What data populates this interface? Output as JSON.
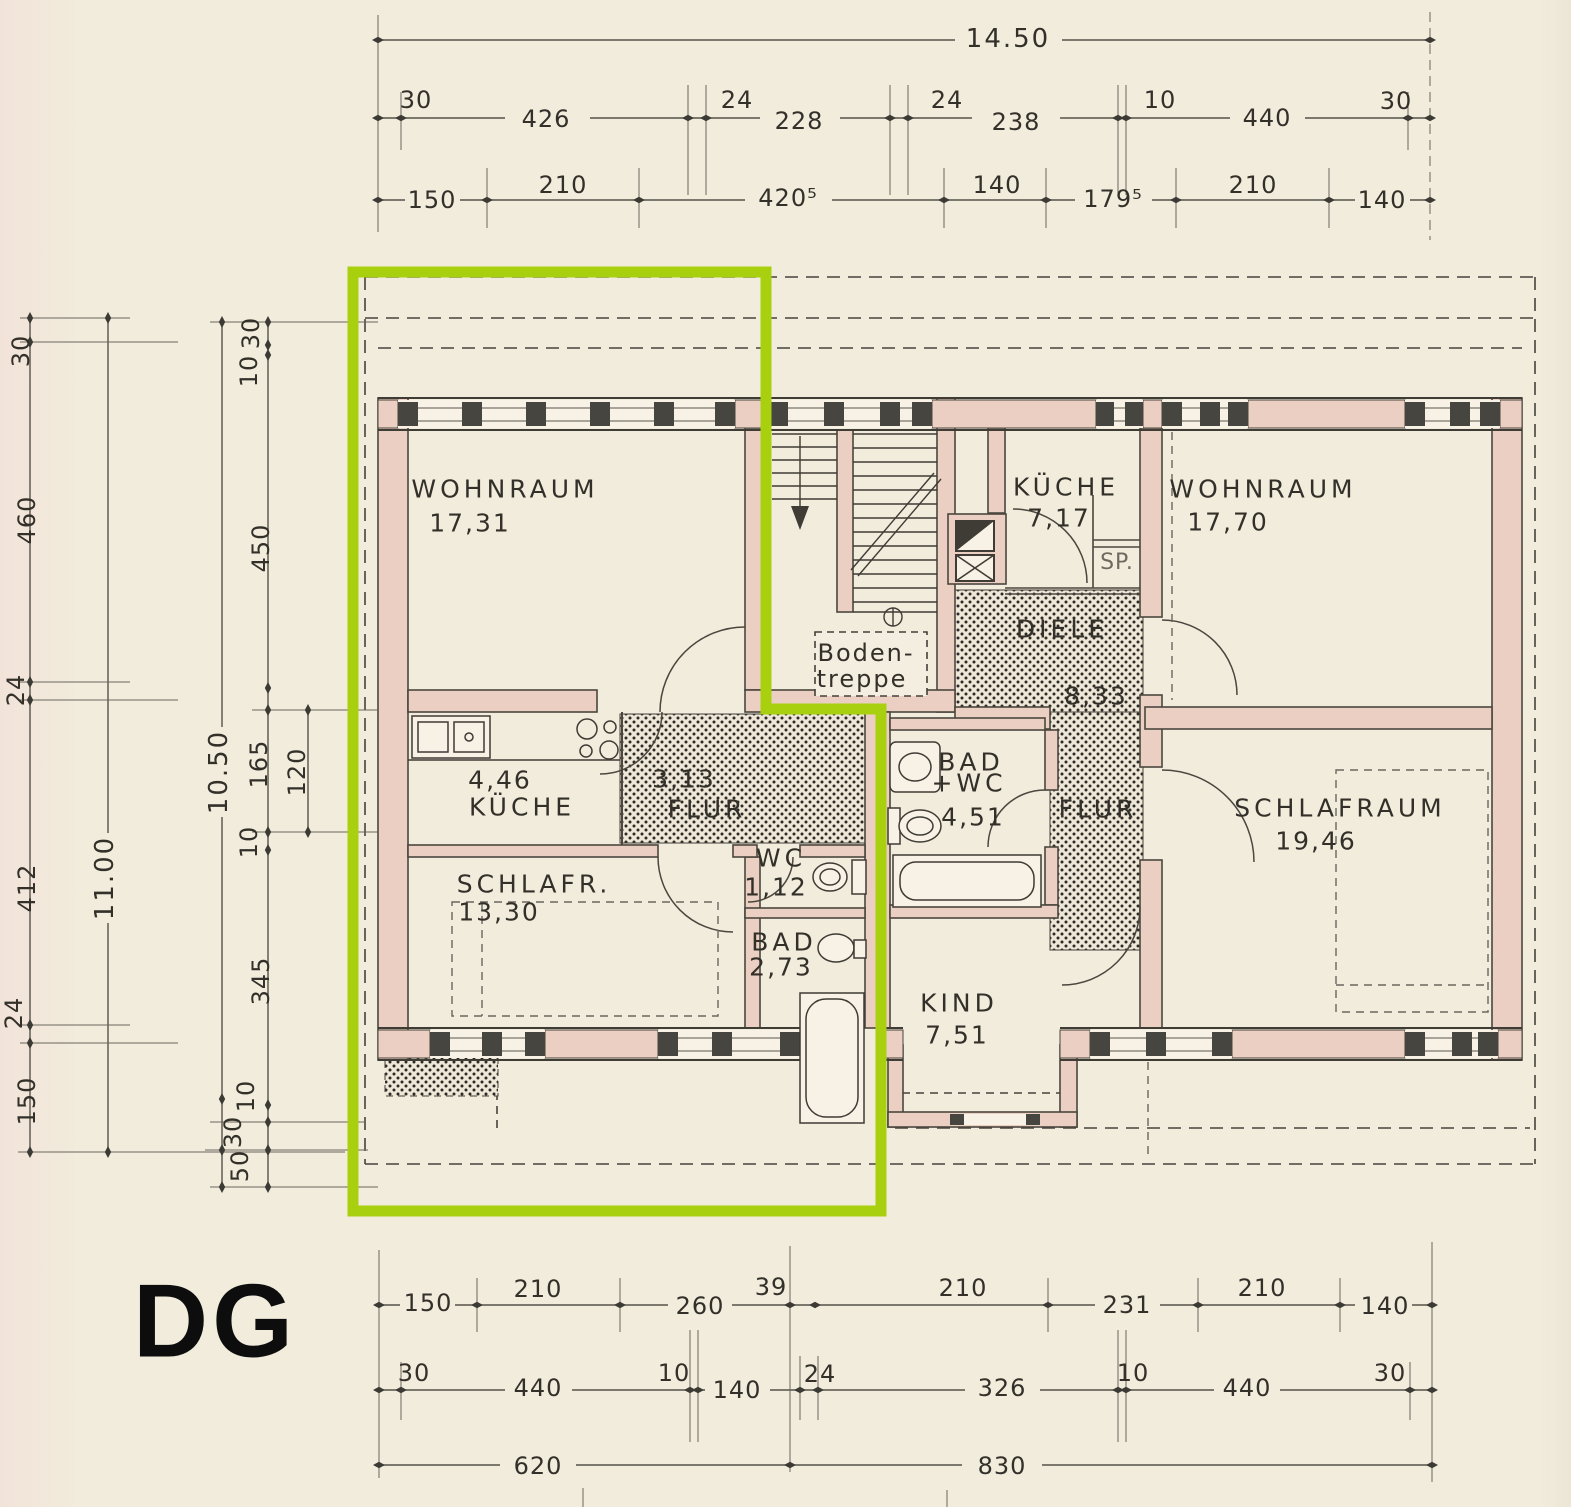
{
  "floor_label": "DG",
  "highlight_color": "#a9d00e",
  "dims": {
    "top_total": "14.50",
    "top_row2": [
      "30",
      "426",
      "24",
      "228",
      "24",
      "238",
      "10",
      "440",
      "30"
    ],
    "top_row3": [
      "150",
      "210",
      "420⁵",
      "140",
      "179⁵",
      "210",
      "140"
    ],
    "left_outer": [
      "30",
      "460",
      "24",
      "412",
      "24",
      "150"
    ],
    "left_total_outer": "11.00",
    "left_total_inner": "10.50",
    "left_inner": [
      "30",
      "10",
      "450",
      "165",
      "10",
      "345",
      "10",
      "30",
      "50"
    ],
    "left_sub": "120",
    "bottom_row1": [
      "150",
      "210",
      "260",
      "39",
      "210",
      "231",
      "210",
      "140"
    ],
    "bottom_row2": [
      "30",
      "440",
      "10",
      "140",
      "24",
      "326",
      "10",
      "440",
      "30"
    ],
    "bottom_row3": [
      "620",
      "830"
    ]
  },
  "rooms": {
    "wohnraum_l": {
      "name": "WOHNRAUM",
      "area": "17,31"
    },
    "kueche_l": {
      "name": "KÜCHE",
      "area": "4,46"
    },
    "flur_l": {
      "name": "FLUR",
      "area": "3,13"
    },
    "schlafr_l": {
      "name": "SCHLAFR.",
      "area": "13,30"
    },
    "wc_l": {
      "name": "WC",
      "area": "1,12"
    },
    "bad_l": {
      "name": "BAD",
      "area": "2,73"
    },
    "kueche_r": {
      "name": "KÜCHE",
      "area": "7,17"
    },
    "sp": {
      "name": "SP."
    },
    "diele": {
      "name": "DIELE",
      "area": "8,33"
    },
    "wohnraum_r": {
      "name": "WOHNRAUM",
      "area": "17,70"
    },
    "flur_r": {
      "name": "FLUR"
    },
    "bad_wc_r": {
      "name": "BAD",
      "name2": "+WC",
      "area": "4,51"
    },
    "schlafraum_r": {
      "name": "SCHLAFRAUM",
      "area": "19,46"
    },
    "kind": {
      "name": "KIND",
      "area": "7,51"
    },
    "bodentreppe": {
      "line1": "Boden-",
      "line2": "treppe"
    }
  }
}
